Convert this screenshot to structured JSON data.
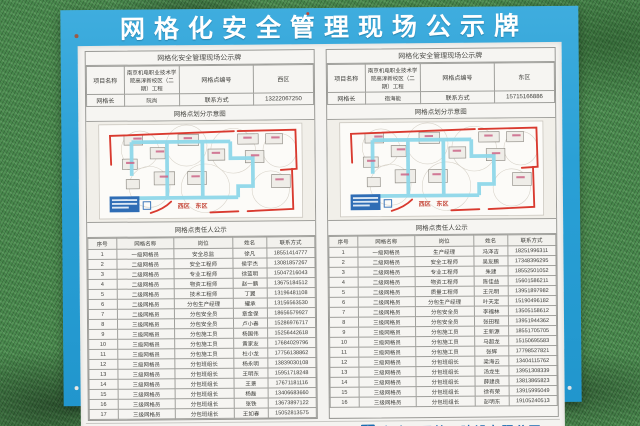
{
  "board": {
    "title": "网格化安全管理现场公示牌",
    "company": "中建八局第三建设有限公司",
    "logo_name": "cscec-logo"
  },
  "colors": {
    "board_blue": "#2aa0d6",
    "turf_green": "#47874b",
    "company_blue": "#1a6cb0",
    "map_road_red": "#d93a2f",
    "map_road_cyan": "#8fd8ea"
  },
  "panels": [
    {
      "subtitle": "网格化安全管理现场公示牌",
      "info": {
        "project_label": "项目名称",
        "project_name": "南京机电职业技术学院高淳新校区（二期）工程",
        "grid_no_label": "网格点编号",
        "grid_no": "西区",
        "leader_label": "网格长",
        "leader_name": "阮尚",
        "contact_label": "联系方式",
        "contact": "13222067250"
      },
      "map_title": "网格点划分示意图",
      "map_labels": {
        "west": "西区",
        "east": "东区"
      },
      "roster_title": "网格点责任人公示",
      "roster_headers": [
        "序号",
        "网格名称",
        "岗位",
        "姓名",
        "联系方式"
      ],
      "roster_rows": [
        [
          "1",
          "一级网格员",
          "安全总监",
          "徐凡",
          "18551414777"
        ],
        [
          "2",
          "二级网格员",
          "安全工程师",
          "侯宇杰",
          "13081857267"
        ],
        [
          "3",
          "二级网格员",
          "专业工程师",
          "徐蓝明",
          "15047216043"
        ],
        [
          "4",
          "二级网格员",
          "物资工程师",
          "赵一鹏",
          "13675184512"
        ],
        [
          "5",
          "二级网格员",
          "技术工程师",
          "丁翼",
          "13196481108"
        ],
        [
          "6",
          "二级网格员",
          "分包生产经理",
          "耀承",
          "13156563530"
        ],
        [
          "7",
          "二级网格员",
          "分包安全员",
          "章金保",
          "18656579927"
        ],
        [
          "8",
          "三级网格员",
          "分包安全员",
          "卢小春",
          "15286976717"
        ],
        [
          "9",
          "三级网格员",
          "分包施工员",
          "杨国伟",
          "15256442618"
        ],
        [
          "10",
          "三级网格员",
          "分包施工员",
          "黄家友",
          "17684029796"
        ],
        [
          "11",
          "三级网格员",
          "分包施工员",
          "杜小龙",
          "17756138862"
        ],
        [
          "12",
          "三级网格员",
          "分包班组长",
          "杨永明",
          "13839030108"
        ],
        [
          "13",
          "三级网格员",
          "分包班组长",
          "王明东",
          "15951718248"
        ],
        [
          "14",
          "三级网格员",
          "分包班组长",
          "王景",
          "17671181116"
        ],
        [
          "15",
          "三级网格员",
          "分包班组长",
          "杨磊",
          "13406683660"
        ],
        [
          "16",
          "三级网格员",
          "分包班组长",
          "张铁",
          "13673897122"
        ],
        [
          "17",
          "三级网格员",
          "分包班组长",
          "王如春",
          "15052813575"
        ]
      ]
    },
    {
      "subtitle": "网格化安全管理现场公示牌",
      "info": {
        "project_label": "项目名称",
        "project_name": "南京机电职业技术学院高淳新校区（二期）工程",
        "grid_no_label": "网格点编号",
        "grid_no": "东区",
        "leader_label": "网格长",
        "leader_name": "宿海能",
        "contact_label": "联系方式",
        "contact": "15715166886"
      },
      "map_title": "网格点划分示意图",
      "map_labels": {
        "west": "西区",
        "east": "东区"
      },
      "roster_title": "网格点责任人公示",
      "roster_headers": [
        "序号",
        "网格名称",
        "岗位",
        "姓名",
        "联系方式"
      ],
      "roster_rows": [
        [
          "1",
          "一级网格员",
          "生产经理",
          "冯泽吉",
          "18251996311"
        ],
        [
          "2",
          "二级网格员",
          "安全工程师",
          "吴友鹏",
          "17348396295"
        ],
        [
          "3",
          "二级网格员",
          "专业工程师",
          "朱建",
          "18552501052"
        ],
        [
          "4",
          "二级网格员",
          "物资工程师",
          "陈佳益",
          "15601586211"
        ],
        [
          "5",
          "二级网格员",
          "质量工程师",
          "王元明",
          "13951897982"
        ],
        [
          "6",
          "二级网格员",
          "分包生产经理",
          "叶天定",
          "15190496182"
        ],
        [
          "7",
          "二级网格员",
          "分包安全员",
          "李福林",
          "13505158612"
        ],
        [
          "8",
          "三级网格员",
          "分包安全员",
          "张田程",
          "13951944362"
        ],
        [
          "9",
          "三级网格员",
          "分包施工员",
          "王新源",
          "18551705705"
        ],
        [
          "10",
          "三级网格员",
          "分包施工员",
          "马超龙",
          "15150695583"
        ],
        [
          "11",
          "三级网格员",
          "分包施工员",
          "张辉",
          "17798527821"
        ],
        [
          "12",
          "三级网格员",
          "分包班组长",
          "梁海云",
          "13404115762"
        ],
        [
          "13",
          "三级网格员",
          "分包班组长",
          "汤龙生",
          "13951308339"
        ],
        [
          "14",
          "三级网格员",
          "分包班组长",
          "薛建良",
          "13813865823"
        ],
        [
          "15",
          "三级网格员",
          "分包班组长",
          "徐有荣",
          "13915995049"
        ],
        [
          "16",
          "三级网格员",
          "分包班组长",
          "彭明东",
          "19105240513"
        ]
      ]
    }
  ]
}
